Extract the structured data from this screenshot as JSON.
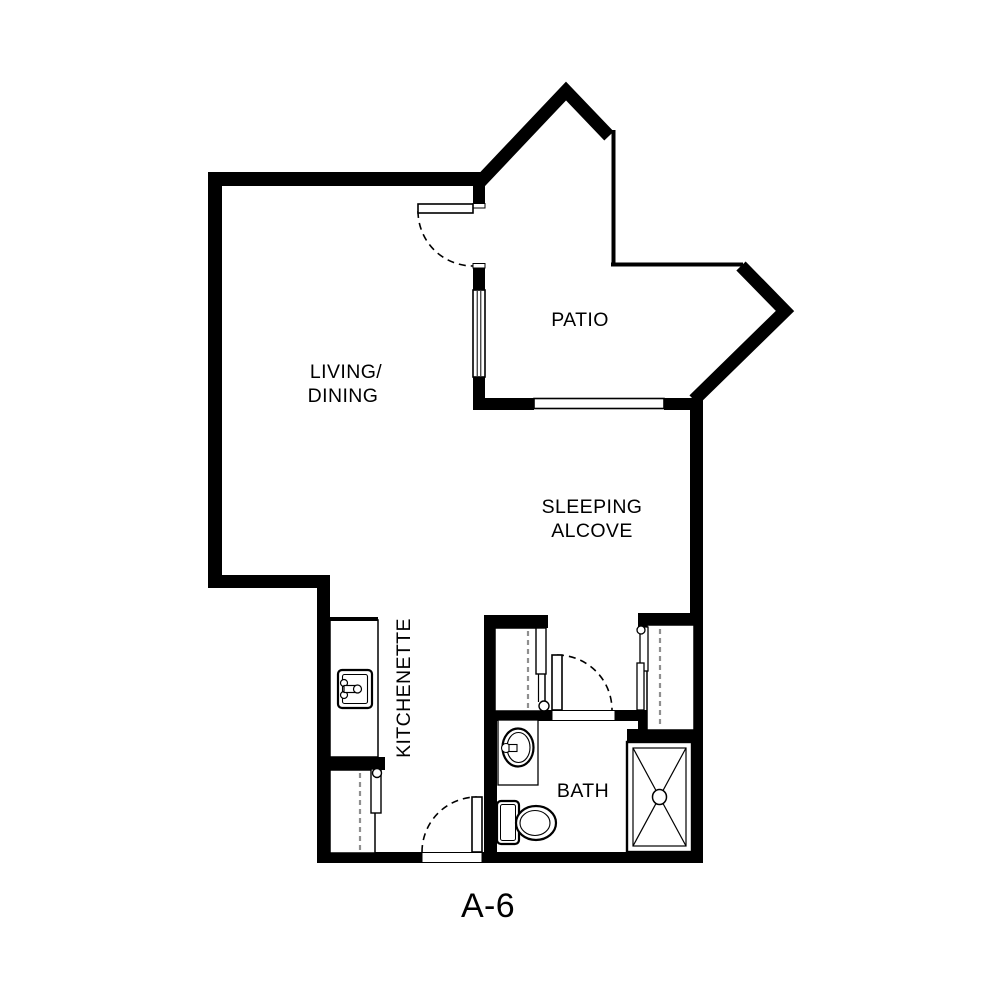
{
  "unit_label": "A-6",
  "rooms": {
    "living_dining": {
      "line1": "LIVING/",
      "line2": "DINING"
    },
    "patio": {
      "label": "PATIO"
    },
    "sleeping_alcove": {
      "line1": "SLEEPING",
      "line2": "ALCOVE"
    },
    "kitchenette": {
      "label": "KITCHENETTE"
    },
    "bath": {
      "label": "BATH"
    }
  },
  "fixtures": [
    "kitchen-sink",
    "bathroom-sink",
    "toilet",
    "shower",
    "kitchen-closet",
    "hall-closet-left",
    "hall-closet-right",
    "entry-door",
    "patio-door",
    "bath-door",
    "patio-window-side",
    "patio-window-bottom"
  ],
  "colors": {
    "line": "#000000",
    "background": "#ffffff",
    "closet_dash": "#8f8f8f"
  }
}
